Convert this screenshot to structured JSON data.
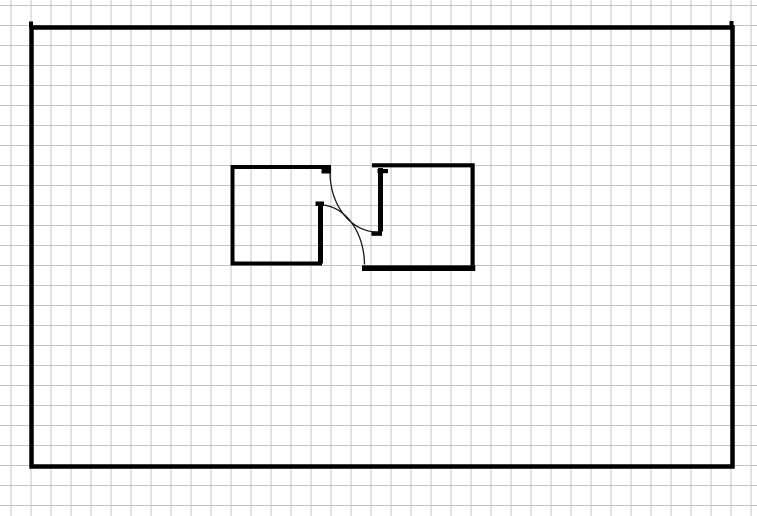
{
  "app": {
    "title": "Floor plan sketch on grid paper",
    "description": "Black-line architectural sketch: one large outer room and two small inner rooms joined by a doorway with two crossing door-swing arcs. No visible text, toolbars or labels."
  },
  "canvas": {
    "width": 757,
    "height": 516,
    "background_color": "#ffffff"
  },
  "grid": {
    "color": "#c6c6c6",
    "cell_width": 20,
    "cell_height": 20,
    "offset_x": 10.5,
    "offset_y": 5,
    "line_thickness_px": 1
  },
  "palette": {
    "wall_color": "#000000",
    "door_arc_color": "#1a1a1a"
  },
  "floorplan": {
    "outer_room": {
      "wall_path": "M 31.5 27.5 H 732.5 V 466.5 H 31.5 Z",
      "corner_marks": [
        {
          "id": "outer-corner-mark-top-left",
          "path": "M 29 21.5 h 4 v 6.5 h -4 Z"
        },
        {
          "id": "outer-corner-mark-top-right",
          "path": "M 729.5 21 h 4 v 6.5 h -4 Z"
        }
      ]
    },
    "left_room": {
      "wall_path": "M 331 167 H 232.5 V 263.5 H 322",
      "door_jamb_path": "M 320.5 203 V 263.5",
      "hinge_marks": [
        {
          "id": "left-room-lintel-hinge-block",
          "path": "M 321.5 168.5 h 9.5 v 5 h -9.5 Z"
        },
        {
          "id": "left-room-jamb-top-block",
          "path": "M 315.5 201.5 h 8.5 v 4.5 h -8.5 Z"
        }
      ]
    },
    "right_room": {
      "wall_path": "M 372 165.3 H 472.6 V 268",
      "bottom_wall_path": "M 362 268.2 H 475.3",
      "door_jamb_path": "M 380.5 168 V 231.5",
      "hinge_marks": [
        {
          "id": "right-room-lintel-hinge-block",
          "path": "M 377.5 169 h 10.5 v 4.2 h -10.5 Z"
        },
        {
          "id": "right-room-jamb-foot-block",
          "path": "M 371.5 231.3 h 10.5 v 4.5 h -10.5 Z"
        }
      ]
    },
    "door_swings": [
      {
        "id": "door-swing-upper",
        "path": "M 330 172.5 A 47 59.5 0 0 0 377 232"
      },
      {
        "id": "door-swing-lower",
        "path": "M 322.5 205 A 44.5 60 0 0 1 364.5 264.5"
      }
    ]
  }
}
